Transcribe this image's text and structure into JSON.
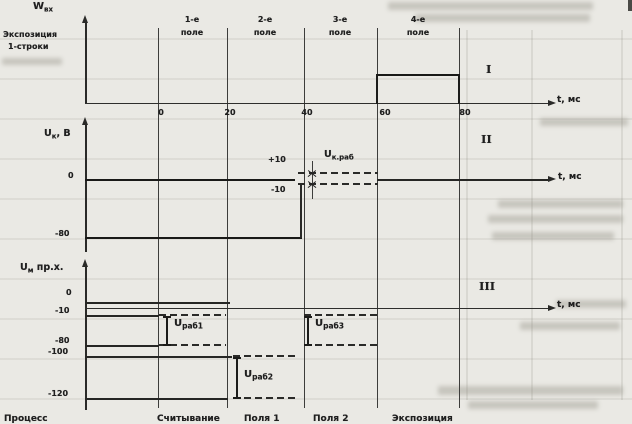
{
  "paper": {
    "background": "#eae9e4",
    "ink": "#1f1f1f",
    "bleed_faint": "#b8b6ad"
  },
  "fields": [
    {
      "num": "1-е",
      "word": "поле"
    },
    {
      "num": "2-е",
      "word": "поле"
    },
    {
      "num": "3-е",
      "word": "поле"
    },
    {
      "num": "4-е",
      "word": "поле"
    }
  ],
  "panel1": {
    "ylabel_main": "W",
    "ylabel_sub": "вх",
    "exposure_line1": "Экспозиция",
    "exposure_line2": "1-строки",
    "numeral": "I",
    "t_label": "t, мс",
    "ticks": [
      "0",
      "20",
      "40",
      "60",
      "80"
    ]
  },
  "panel2": {
    "ylabel_main": "U",
    "ylabel_sub": "к",
    "ylabel_rest": ", В",
    "zero": "0",
    "plus10": "+10",
    "minus10": "-10",
    "minus80": "-80",
    "band_main": "U",
    "band_sub": "к.раб",
    "numeral": "II",
    "t_label": "t, мс"
  },
  "panel3": {
    "ylabel_main": "U",
    "ylabel_sub": "м",
    "ylabel_rest": " пр.х.",
    "zero": "0",
    "m10": "-10",
    "m80": "-80",
    "m100": "-100",
    "m120": "-120",
    "b1_main": "U",
    "b1_sub": "раб1",
    "b2_main": "U",
    "b2_sub": "раб2",
    "b3_main": "U",
    "b3_sub": "раб3",
    "numeral": "III",
    "t_label": "t, мс"
  },
  "bottom": {
    "process": "Процесс",
    "readout": "Считывание",
    "field1": "Поля 1",
    "field2": "Поля 2",
    "exposure": "Экспозиция"
  },
  "chart_data": {
    "type": "line",
    "subtype": "timing-diagram",
    "x_unit": "мс",
    "x_ticks": [
      0,
      20,
      40,
      60,
      80
    ],
    "fields": [
      {
        "label": "1-е поле",
        "range_ms": [
          0,
          20
        ]
      },
      {
        "label": "2-е поле",
        "range_ms": [
          20,
          40
        ]
      },
      {
        "label": "3-е поле",
        "range_ms": [
          40,
          60
        ]
      },
      {
        "label": "4-е поле",
        "range_ms": [
          60,
          80
        ]
      }
    ],
    "panels": [
      {
        "numeral": "I",
        "ylabel": "Wвх",
        "annotation": "Экспозиция 1-строки",
        "waveform": [
          {
            "t": [
              0,
              60
            ],
            "level": 0
          },
          {
            "t": [
              60,
              80
            ],
            "level": "high pulse"
          },
          {
            "t": [
              80,
              80
            ],
            "level": 0
          }
        ]
      },
      {
        "numeral": "II",
        "ylabel": "Uк, В",
        "level_labels": [
          0,
          10,
          -10,
          -80
        ],
        "segments": [
          {
            "t": [
              0,
              40
            ],
            "level_V": 0,
            "style": "solid"
          },
          {
            "t": [
              0,
              40
            ],
            "level_V": -80,
            "style": "solid"
          },
          {
            "t": [
              40,
              60
            ],
            "band_V": [
              10,
              -10
            ],
            "label": "Uк.раб",
            "style": "dashed"
          },
          {
            "t": [
              60,
              80
            ],
            "level_V": 0,
            "style": "solid"
          }
        ]
      },
      {
        "numeral": "III",
        "ylabel": "Uм пр.х.",
        "level_labels": [
          0,
          -10,
          -80,
          -100,
          -120
        ],
        "segments": [
          {
            "t": [
              0,
              20
            ],
            "band_V": [
              -10,
              -80
            ],
            "label": "Uраб1",
            "style": "dashed"
          },
          {
            "t": [
              20,
              40
            ],
            "band_V": [
              -100,
              -120
            ],
            "label": "Uраб2",
            "style": "dashed"
          },
          {
            "t": [
              40,
              60
            ],
            "band_V": [
              -10,
              -80
            ],
            "label": "Uраб3",
            "style": "dashed"
          }
        ]
      }
    ],
    "bottom_process_row": [
      "Процесс",
      "Считывание",
      "Поля 1",
      "Поля 2",
      "Экспозиция"
    ]
  }
}
